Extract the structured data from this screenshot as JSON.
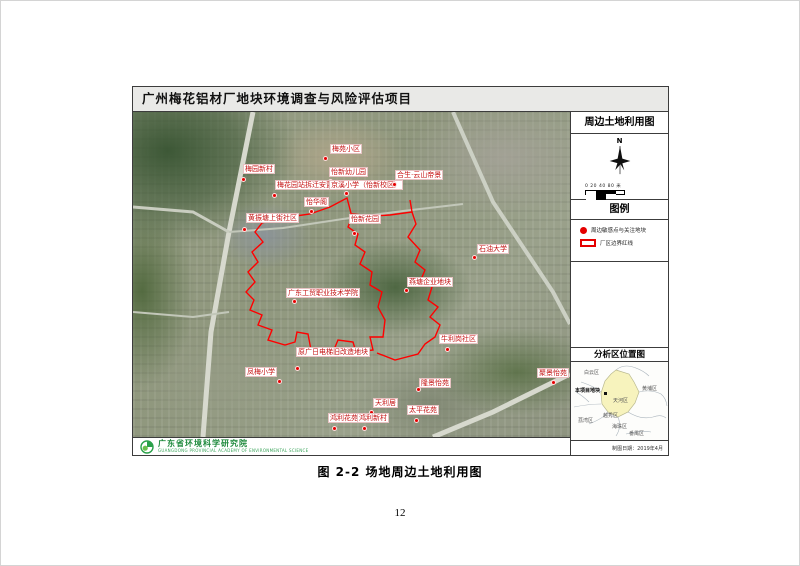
{
  "page": {
    "title": "广州梅花铝材厂地块环境调查与风险评估项目",
    "caption": "图 2-2 场地周边土地利用图",
    "page_number": "12"
  },
  "sidebar": {
    "map_title": "周边土地利用图",
    "north_label": "N",
    "scale_text": "0 20 40      80 米",
    "legend_title": "图例",
    "legend_items": [
      {
        "symbol": "red-dot",
        "label": "周边敏感点与关注地块"
      },
      {
        "symbol": "red-rect",
        "label": "厂区边界红线"
      }
    ],
    "locator_title": "分析区位置图",
    "locator_labels": [
      {
        "text": "白云区",
        "x": 13,
        "y": 9,
        "bold": false
      },
      {
        "text": "本项目地块",
        "x": 4,
        "y": 27,
        "bold": true
      },
      {
        "text": "天河区",
        "x": 42,
        "y": 37,
        "bold": false
      },
      {
        "text": "黄埔区",
        "x": 71,
        "y": 25,
        "bold": false
      },
      {
        "text": "越秀区",
        "x": 32,
        "y": 52,
        "bold": false
      },
      {
        "text": "荔湾区",
        "x": 7,
        "y": 57,
        "bold": false
      },
      {
        "text": "海珠区",
        "x": 41,
        "y": 63,
        "bold": false
      },
      {
        "text": "番禺区",
        "x": 58,
        "y": 70,
        "bold": false
      }
    ],
    "date_text": "制图日期：2019年4月"
  },
  "footer": {
    "org_name": "广东省环境科学研究院",
    "org_subtitle": "GUANGDONG PROVINCIAL ACADEMY OF ENVIRONMENTAL SCIENCE"
  },
  "map": {
    "labels": [
      {
        "text": "梅苑小区",
        "x": 197,
        "y": 32,
        "dot": [
          190,
          44
        ]
      },
      {
        "text": "梅园新村",
        "x": 110,
        "y": 52,
        "dot": [
          108,
          65
        ]
      },
      {
        "text": "怡新幼儿园",
        "x": 196,
        "y": 55,
        "dot": [
          195,
          67
        ]
      },
      {
        "text": "梅花园站拆迁安置房",
        "x": 142,
        "y": 68,
        "dot": [
          139,
          81
        ]
      },
      {
        "text": "京溪小学（怡新校区）",
        "x": 196,
        "y": 68,
        "dot": [
          211,
          79
        ]
      },
      {
        "text": "合生·云山帝景",
        "x": 262,
        "y": 58,
        "dot": [
          259,
          70
        ]
      },
      {
        "text": "怡华阁",
        "x": 171,
        "y": 85,
        "dot": [
          176,
          97
        ]
      },
      {
        "text": "黄振塘上街社区",
        "x": 113,
        "y": 101,
        "dot": [
          109,
          115
        ]
      },
      {
        "text": "怡新花园",
        "x": 216,
        "y": 102,
        "dot": [
          219,
          119
        ]
      },
      {
        "text": "石油大学",
        "x": 344,
        "y": 132,
        "dot": [
          339,
          143
        ]
      },
      {
        "text": "燕塘企业地块",
        "x": 274,
        "y": 165,
        "dot": [
          271,
          176
        ]
      },
      {
        "text": "广东工贸职业技术学院",
        "x": 153,
        "y": 176,
        "dot": [
          159,
          187
        ]
      },
      {
        "text": "牛利岗社区",
        "x": 306,
        "y": 222,
        "dot": [
          312,
          235
        ]
      },
      {
        "text": "原广日电梯旧改造地块",
        "x": 163,
        "y": 235,
        "dot": [
          162,
          254
        ]
      },
      {
        "text": "凤梅小学",
        "x": 112,
        "y": 255,
        "dot": [
          144,
          267
        ]
      },
      {
        "text": "隆景怡苑",
        "x": 286,
        "y": 266,
        "dot": [
          283,
          275
        ]
      },
      {
        "text": "聚景怡苑",
        "x": 404,
        "y": 256,
        "dot": [
          418,
          268
        ]
      },
      {
        "text": "天利居",
        "x": 240,
        "y": 286,
        "dot": [
          236,
          298
        ]
      },
      {
        "text": "太平花苑",
        "x": 274,
        "y": 293,
        "dot": [
          281,
          306
        ]
      },
      {
        "text": "鸿利花苑",
        "x": 195,
        "y": 301,
        "dot": [
          199,
          314
        ]
      },
      {
        "text": "鸿利新村",
        "x": 224,
        "y": 301,
        "dot": [
          229,
          314
        ]
      }
    ]
  },
  "colors": {
    "boundary_red": "#ff0000",
    "label_red": "#c41111",
    "org_green": "#1f8a3d",
    "locator_fill": "#f7f3bd"
  }
}
